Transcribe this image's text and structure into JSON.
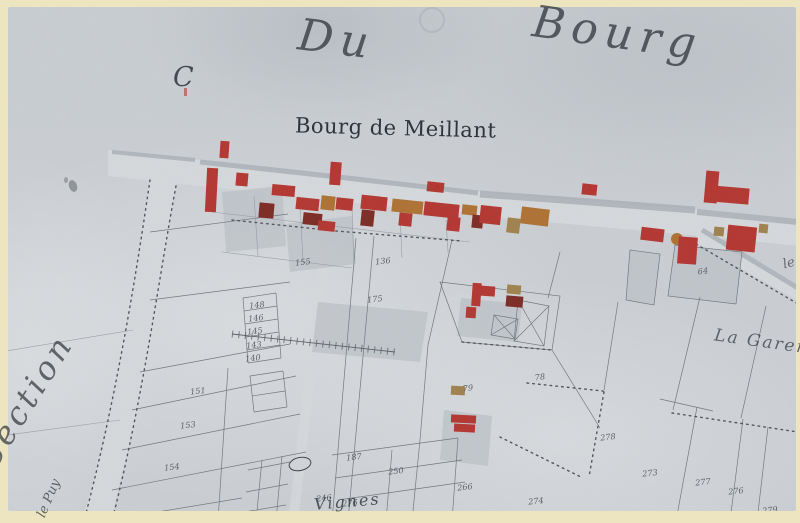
{
  "map": {
    "header": {
      "word1": "Du",
      "word2": "Bourg"
    },
    "section_letter": "C",
    "village_label": "Bourg de Meillant",
    "side_label": "Section",
    "right_label": "La Garen",
    "bottom_label": "Vignes",
    "road_label": "le Puy",
    "right_edge_label": "le",
    "parcel_numbers": [
      {
        "t": "148",
        "x": 257,
        "y": 306
      },
      {
        "t": "146",
        "x": 256,
        "y": 319
      },
      {
        "t": "145",
        "x": 255,
        "y": 332
      },
      {
        "t": "143",
        "x": 254,
        "y": 346
      },
      {
        "t": "140",
        "x": 253,
        "y": 359
      },
      {
        "t": "151",
        "x": 198,
        "y": 392
      },
      {
        "t": "153",
        "x": 188,
        "y": 426
      },
      {
        "t": "154",
        "x": 172,
        "y": 468
      },
      {
        "t": "155",
        "x": 303,
        "y": 263
      },
      {
        "t": "136",
        "x": 383,
        "y": 262
      },
      {
        "t": "175",
        "x": 375,
        "y": 300
      },
      {
        "t": "187",
        "x": 354,
        "y": 458
      },
      {
        "t": "250",
        "x": 396,
        "y": 472
      },
      {
        "t": "246",
        "x": 324,
        "y": 499
      },
      {
        "t": "276",
        "x": 350,
        "y": 504
      },
      {
        "t": "79",
        "x": 468,
        "y": 389
      },
      {
        "t": "78",
        "x": 540,
        "y": 378
      },
      {
        "t": "64",
        "x": 703,
        "y": 272
      },
      {
        "t": "278",
        "x": 608,
        "y": 438
      },
      {
        "t": "273",
        "x": 650,
        "y": 474
      },
      {
        "t": "266",
        "x": 465,
        "y": 488
      },
      {
        "t": "274",
        "x": 536,
        "y": 502
      },
      {
        "t": "277",
        "x": 703,
        "y": 483
      },
      {
        "t": "276",
        "x": 736,
        "y": 492
      },
      {
        "t": "279",
        "x": 770,
        "y": 511
      }
    ],
    "colors": {
      "paper": "#cdd1d5",
      "border": "#ece5bf",
      "road": "#d9dcdf",
      "line": "#70757b",
      "ink": "#383d44",
      "building_red": "#b5302a",
      "building_orange": "#b06f2c",
      "building_dark": "#7c241d",
      "courtyard": "#bdc3c8"
    }
  }
}
